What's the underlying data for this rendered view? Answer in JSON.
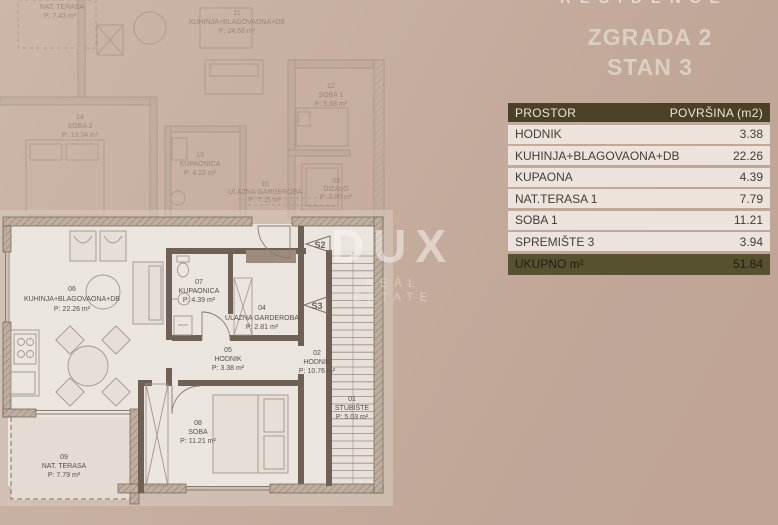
{
  "brand": {
    "residence": "RESIDENCE",
    "dux": "DUX",
    "dux_sub": "REAL ESTATE"
  },
  "title": {
    "line1": "ZGRADA 2",
    "line2": "STAN 3"
  },
  "table": {
    "header": {
      "col1": "PROSTOR",
      "col2": "POVRŠINA (m2)"
    },
    "rows": [
      {
        "name": "HODNIK",
        "area": "3.38"
      },
      {
        "name": "KUHINJA+BLAGOVAONA+DB",
        "area": "22.26"
      },
      {
        "name": "KUPAONA",
        "area": "4.39"
      },
      {
        "name": "NAT.TERASA 1",
        "area": "7.79"
      },
      {
        "name": "SOBA 1",
        "area": "11.21"
      },
      {
        "name": "SPREMIŠTE 3",
        "area": "3.94"
      }
    ],
    "total": {
      "name": "UKUPNO m²",
      "area": "51.84"
    }
  },
  "floorplan": {
    "active_rooms": [
      {
        "num": "06",
        "name": "KUHINJA+BLAGOVAONA+DB",
        "area": "P: 22.26 m²"
      },
      {
        "num": "07",
        "name": "KUPAONICA",
        "area": "P: 4.39 m²"
      },
      {
        "num": "04",
        "name": "ULAZNA GARDEROBA",
        "area": "P: 2.81 m²"
      },
      {
        "num": "05",
        "name": "HODNIK",
        "area": "P: 3.38 m²"
      },
      {
        "num": "02",
        "name": "HODNIK",
        "area": "P: 10.76 m²"
      },
      {
        "num": "01",
        "name": "STUBIŠTE",
        "area": "P: 5.03 m²"
      },
      {
        "num": "08",
        "name": "SOBA",
        "area": "P: 11.21 m²"
      },
      {
        "num": "09",
        "name": "NAT. TERASA",
        "area": "P: 7.79 m²"
      }
    ],
    "faded_rooms": [
      {
        "num": "",
        "name": "NAT. TERASA",
        "area": "P: 7.43 m²"
      },
      {
        "num": "11",
        "name": "KUHINJA+BLAGOVAONA+DB",
        "area": "P: 24.66 m²"
      },
      {
        "num": "12",
        "name": "SOBA 1",
        "area": "P: 5.68 m²"
      },
      {
        "num": "14",
        "name": "SOBA 2",
        "area": "P: 13.34 m²"
      },
      {
        "num": "13",
        "name": "KUPAONICA",
        "area": "P: 4.22 m²"
      },
      {
        "num": "10",
        "name": "ULAZNA GARDEROBA",
        "area": "P: 7.15 m²"
      },
      {
        "num": "03",
        "name": "DIZALO",
        "area": "P: 3.80 m²"
      }
    ],
    "markers": [
      "S2",
      "S3"
    ]
  },
  "colors": {
    "background": "#c2a89a",
    "table_header_bg": "#4a4126",
    "table_row_bg": "#ebe3dc",
    "table_total_bg": "#56512e",
    "wall": "#6e6055",
    "interior": "#ebe5df",
    "accent_text": "#dbcec3"
  }
}
